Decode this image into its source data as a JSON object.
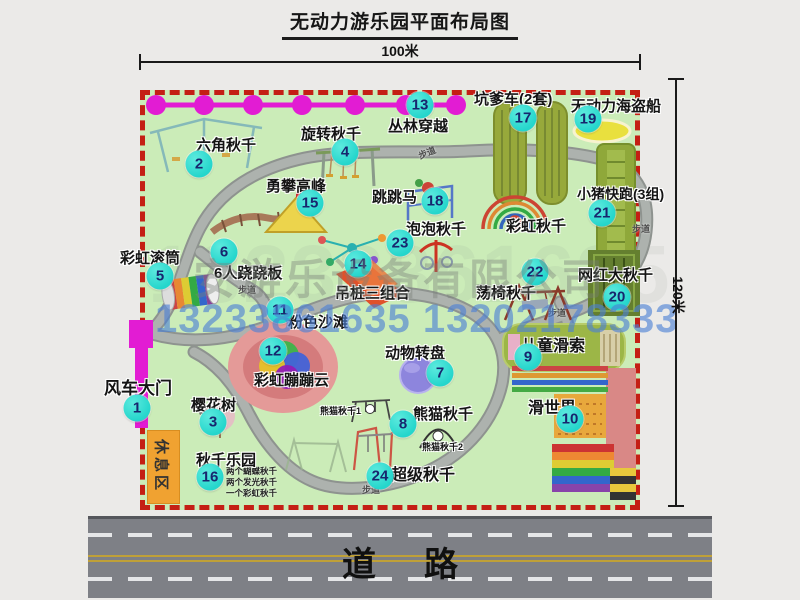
{
  "title": "无动力游乐园平面布局图",
  "dimensions": {
    "width_label": "100米",
    "height_label": "120米"
  },
  "watermark": {
    "company": "安游乐设备有限公司",
    "phone": "13233861635 13202178333",
    "ghost_number": "13233861635"
  },
  "road": {
    "label": "道路"
  },
  "rest_area": {
    "label": "休息区"
  },
  "walkway": {
    "label_text": "步道",
    "labels": [
      [
        418,
        146,
        -22
      ],
      [
        632,
        222,
        0
      ],
      [
        238,
        283,
        0
      ],
      [
        193,
        399,
        78
      ],
      [
        362,
        483,
        0
      ],
      [
        548,
        306,
        0
      ]
    ]
  },
  "attractions": [
    {
      "num": "1",
      "name": "风车大门",
      "badge": [
        137,
        408
      ],
      "label": [
        104,
        374
      ],
      "size": 17
    },
    {
      "num": "2",
      "name": "六角秋千",
      "badge": [
        199,
        164
      ],
      "label": [
        196,
        134
      ],
      "size": 15
    },
    {
      "num": "3",
      "name": "樱花树",
      "badge": [
        213,
        422
      ],
      "label": [
        191,
        394
      ],
      "size": 15
    },
    {
      "num": "4",
      "name": "旋转秋千",
      "badge": [
        345,
        152
      ],
      "label": [
        301,
        123
      ],
      "size": 15
    },
    {
      "num": "5",
      "name": "彩虹滚筒",
      "badge": [
        160,
        276
      ],
      "label": [
        120,
        247
      ],
      "size": 15
    },
    {
      "num": "6",
      "name": "6人跷跷板",
      "badge": [
        224,
        252
      ],
      "label": [
        214,
        262
      ],
      "size": 15
    },
    {
      "num": "7",
      "name": "动物转盘",
      "badge": [
        440,
        373
      ],
      "label": [
        385,
        342
      ],
      "size": 15
    },
    {
      "num": "8",
      "name": "熊猫秋千",
      "badge": [
        403,
        424
      ],
      "label": [
        413,
        403
      ],
      "size": 15
    },
    {
      "num": "9",
      "name": "儿童滑索",
      "badge": [
        528,
        357
      ],
      "label": [
        521,
        332
      ],
      "size": 16
    },
    {
      "num": "10",
      "name": "滑世界",
      "badge": [
        570,
        419
      ],
      "label": [
        528,
        394
      ],
      "size": 16
    },
    {
      "num": "11",
      "name": "粉色沙滩",
      "badge": [
        280,
        310
      ],
      "label": [
        288,
        311
      ],
      "size": 15
    },
    {
      "num": "12",
      "name": "彩虹蹦蹦云",
      "badge": [
        273,
        351
      ],
      "label": [
        254,
        369
      ],
      "size": 15
    },
    {
      "num": "13",
      "name": "丛林穿越",
      "badge": [
        420,
        105
      ],
      "label": [
        388,
        115
      ],
      "size": 15
    },
    {
      "num": "14",
      "name": "吊桩三组合",
      "badge": [
        358,
        264
      ],
      "label": [
        335,
        282
      ],
      "size": 15
    },
    {
      "num": "15",
      "name": "勇攀高峰",
      "badge": [
        310,
        203
      ],
      "label": [
        266,
        175
      ],
      "size": 15
    },
    {
      "num": "16",
      "name": "秋千乐园",
      "badge": [
        210,
        477
      ],
      "label": [
        196,
        449
      ],
      "size": 15
    },
    {
      "num": "17",
      "name": "坑爹车(2套)",
      "badge": [
        523,
        118
      ],
      "label": [
        474,
        88
      ],
      "size": 15
    },
    {
      "num": "18",
      "name": "跳跳马",
      "badge": [
        435,
        201
      ],
      "label": [
        372,
        186
      ],
      "size": 15
    },
    {
      "num": "19",
      "name": "无动力海盗船",
      "badge": [
        588,
        119
      ],
      "label": [
        571,
        95
      ],
      "size": 15
    },
    {
      "num": "20",
      "name": "网红大秋千",
      "badge": [
        617,
        297
      ],
      "label": [
        578,
        264
      ],
      "size": 15
    },
    {
      "num": "21",
      "name": "小猪快跑(3组)",
      "badge": [
        602,
        213
      ],
      "label": [
        577,
        184
      ],
      "size": 14
    },
    {
      "num": "22",
      "name": "荡椅秋千",
      "badge": [
        535,
        272
      ],
      "label": [
        476,
        282
      ],
      "size": 15
    },
    {
      "num": "23",
      "name": "泡泡秋千",
      "badge": [
        400,
        243
      ],
      "label": [
        406,
        218
      ],
      "size": 15
    },
    {
      "num": "24",
      "name": "超级秋千",
      "badge": [
        380,
        476
      ],
      "label": [
        391,
        461
      ],
      "size": 16
    }
  ],
  "annotations": [
    {
      "text": "彩虹秋千",
      "x": 506,
      "y": 215,
      "size": 15
    },
    {
      "text": "熊猫秋千1",
      "x": 320,
      "y": 404,
      "size": 9
    },
    {
      "text": "熊猫秋千2",
      "x": 422,
      "y": 440,
      "size": 9
    }
  ],
  "swing_notes": {
    "pos": [
      226,
      466
    ],
    "lines": [
      "两个蝴蝶秋千",
      "两个发光秋千",
      "一个彩虹秋千"
    ]
  },
  "colors": {
    "park_green": "#cbecb8",
    "border_red": "#c41f14",
    "badge_teal": "#25d6cc",
    "badge_num": "#17266e",
    "magenta": "#e21cd3",
    "orange": "#f0a231",
    "olive": "#97a93b",
    "dark_green": "#647f2f",
    "road_gray": "#7e8086",
    "lane_white": "#e5e6e8",
    "lane_yellow": "#bfa038",
    "phone_blue": "#4b80d6",
    "watermark_gray": "#798079",
    "pink": "#e49a98",
    "purple": "#8d85dd",
    "yellow": "#e9e03e"
  }
}
